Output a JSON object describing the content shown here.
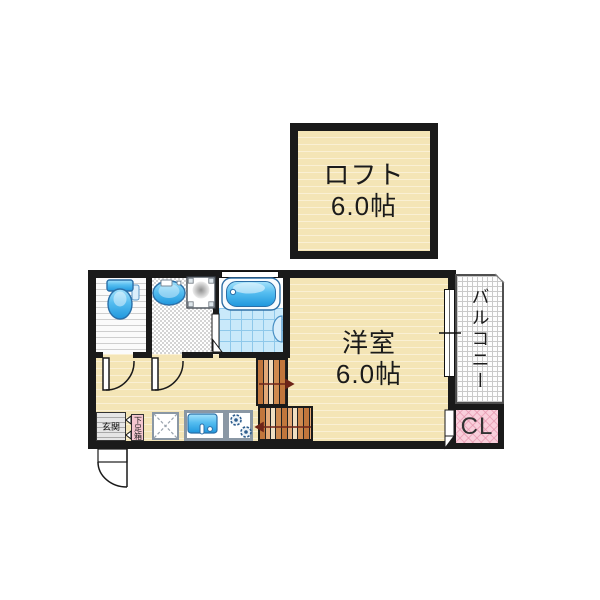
{
  "floorplan": {
    "loft": {
      "name": "ロフト",
      "size": "6.0帖"
    },
    "main_room": {
      "name": "洋室",
      "size": "6.0帖"
    },
    "balcony": {
      "label": "バルコニー"
    },
    "closet": {
      "label": "CL"
    },
    "entrance": {
      "label": "玄関"
    },
    "shoe_cabinet": {
      "label": "下足箱"
    },
    "fixtures": [
      "toilet",
      "washbasin",
      "washing-machine-pan",
      "bathtub",
      "kitchen-sink",
      "gas-stove",
      "appliance-space",
      "staircase"
    ],
    "colors": {
      "wall": "#1a1a1a",
      "tatami": "#f4e5b6",
      "fixture_blue": "#39a8e6",
      "stair_brown": "#c1763c",
      "closet_pink": "#f9cfdb",
      "bath_tile": "#c9e9fa",
      "arrow": "#6e2418"
    }
  }
}
